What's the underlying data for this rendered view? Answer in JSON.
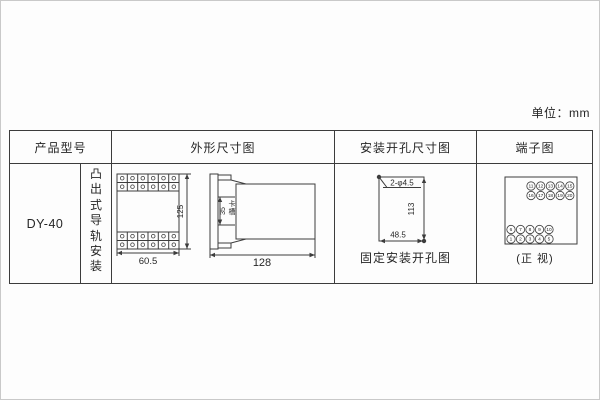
{
  "unit_label": "单位：mm",
  "table": {
    "headers": {
      "product_model": "产品型号",
      "outline": "外形尺寸图",
      "mounting": "安装开孔尺寸图",
      "terminal": "端子图"
    },
    "product_model": "DY-40",
    "mounting_type": "凸出式导轨安装"
  },
  "outline_diagram": {
    "width": "60.5",
    "height": "125",
    "slot_height": "35",
    "slot_label": "卡槽",
    "depth": "128"
  },
  "mounting_diagram": {
    "holes_label": "2-φ4.5",
    "vertical_distance": "113",
    "horizontal_distance": "48.5",
    "caption": "固定安装开孔图"
  },
  "terminal_diagram": {
    "caption": "(正 视)",
    "top_block": {
      "row1": [
        "11",
        "12",
        "13",
        "14",
        "15"
      ],
      "row2": [
        "16",
        "17",
        "18",
        "19",
        "20"
      ]
    },
    "bottom_block": {
      "row1": [
        "6",
        "7",
        "8",
        "9",
        "10"
      ],
      "row2": [
        "1",
        "2",
        "3",
        "4",
        "5"
      ]
    }
  },
  "colors": {
    "line": "#3d3d3d",
    "text": "#262626",
    "page_border": "#c9c9c9"
  }
}
